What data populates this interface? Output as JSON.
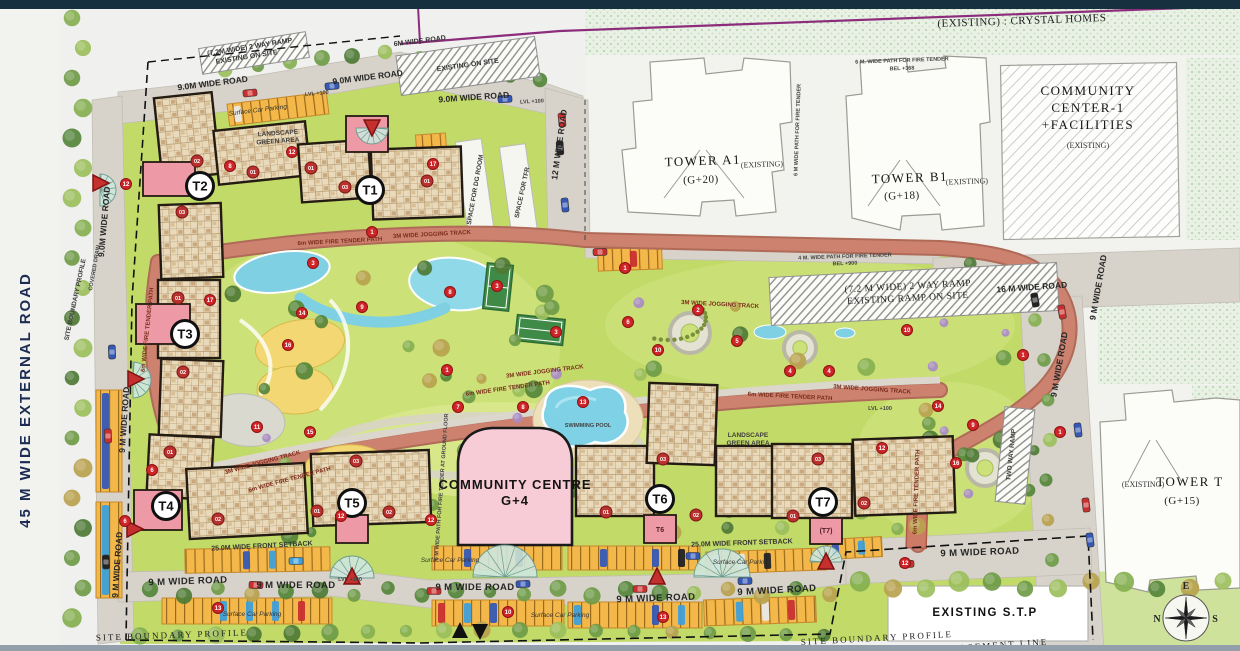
{
  "plan": {
    "title": "Residential Site Master Plan",
    "compass": {
      "n": "N",
      "e": "E",
      "s": "S",
      "w": "W"
    },
    "towers": [
      {
        "id": "T1",
        "x": 370,
        "y": 190
      },
      {
        "id": "T2",
        "x": 200,
        "y": 186
      },
      {
        "id": "T3",
        "x": 185,
        "y": 334
      },
      {
        "id": "T4",
        "x": 166,
        "y": 506
      },
      {
        "id": "T5",
        "x": 352,
        "y": 503
      },
      {
        "id": "T6",
        "x": 660,
        "y": 499
      },
      {
        "id": "T7",
        "x": 823,
        "y": 502
      }
    ],
    "lobby_labels": [
      {
        "t": "T6",
        "x": 660,
        "y": 532
      },
      {
        "t": "(T7)",
        "x": 826,
        "y": 533
      }
    ],
    "unit_badges": [
      {
        "t": "02",
        "x": 197,
        "y": 161
      },
      {
        "t": "01",
        "x": 253,
        "y": 172
      },
      {
        "t": "03",
        "x": 182,
        "y": 212
      },
      {
        "t": "01",
        "x": 311,
        "y": 168
      },
      {
        "t": "03",
        "x": 345,
        "y": 187
      },
      {
        "t": "01",
        "x": 427,
        "y": 181
      },
      {
        "t": "01",
        "x": 178,
        "y": 298
      },
      {
        "t": "02",
        "x": 183,
        "y": 372
      },
      {
        "t": "01",
        "x": 170,
        "y": 452
      },
      {
        "t": "02",
        "x": 218,
        "y": 519
      },
      {
        "t": "01",
        "x": 317,
        "y": 511
      },
      {
        "t": "03",
        "x": 356,
        "y": 461
      },
      {
        "t": "02",
        "x": 389,
        "y": 512
      },
      {
        "t": "01",
        "x": 606,
        "y": 512
      },
      {
        "t": "03",
        "x": 663,
        "y": 459
      },
      {
        "t": "02",
        "x": 696,
        "y": 515
      },
      {
        "t": "01",
        "x": 793,
        "y": 516
      },
      {
        "t": "03",
        "x": 818,
        "y": 459
      },
      {
        "t": "02",
        "x": 864,
        "y": 503
      }
    ],
    "markers": [
      {
        "n": "12",
        "x": 126,
        "y": 184
      },
      {
        "n": "8",
        "x": 230,
        "y": 166
      },
      {
        "n": "12",
        "x": 292,
        "y": 152
      },
      {
        "n": "17",
        "x": 433,
        "y": 164
      },
      {
        "n": "1",
        "x": 372,
        "y": 232
      },
      {
        "n": "3",
        "x": 313,
        "y": 263
      },
      {
        "n": "8",
        "x": 450,
        "y": 292
      },
      {
        "n": "9",
        "x": 362,
        "y": 307
      },
      {
        "n": "14",
        "x": 302,
        "y": 313
      },
      {
        "n": "16",
        "x": 288,
        "y": 345
      },
      {
        "n": "17",
        "x": 210,
        "y": 300
      },
      {
        "n": "11",
        "x": 257,
        "y": 427
      },
      {
        "n": "15",
        "x": 310,
        "y": 432
      },
      {
        "n": "1",
        "x": 447,
        "y": 370
      },
      {
        "n": "7",
        "x": 458,
        "y": 407
      },
      {
        "n": "8",
        "x": 523,
        "y": 407
      },
      {
        "n": "13",
        "x": 583,
        "y": 402
      },
      {
        "n": "3",
        "x": 497,
        "y": 286
      },
      {
        "n": "3",
        "x": 556,
        "y": 332
      },
      {
        "n": "6",
        "x": 628,
        "y": 322
      },
      {
        "n": "10",
        "x": 658,
        "y": 350
      },
      {
        "n": "2",
        "x": 698,
        "y": 310
      },
      {
        "n": "5",
        "x": 737,
        "y": 341
      },
      {
        "n": "4",
        "x": 790,
        "y": 371
      },
      {
        "n": "4",
        "x": 829,
        "y": 371
      },
      {
        "n": "12",
        "x": 882,
        "y": 448
      },
      {
        "n": "14",
        "x": 938,
        "y": 406
      },
      {
        "n": "9",
        "x": 973,
        "y": 425
      },
      {
        "n": "16",
        "x": 956,
        "y": 463
      },
      {
        "n": "1",
        "x": 1023,
        "y": 355
      },
      {
        "n": "1",
        "x": 1060,
        "y": 432
      },
      {
        "n": "10",
        "x": 907,
        "y": 330
      },
      {
        "n": "6",
        "x": 152,
        "y": 470
      },
      {
        "n": "6",
        "x": 125,
        "y": 521
      },
      {
        "n": "12",
        "x": 341,
        "y": 516
      },
      {
        "n": "12",
        "x": 431,
        "y": 520
      },
      {
        "n": "1",
        "x": 625,
        "y": 268
      },
      {
        "n": "13",
        "x": 218,
        "y": 608
      },
      {
        "n": "10",
        "x": 508,
        "y": 612
      },
      {
        "n": "13",
        "x": 663,
        "y": 617
      },
      {
        "n": "12",
        "x": 905,
        "y": 563
      }
    ],
    "labels": [
      {
        "t": "45 M WIDE EXTERNAL ROAD",
        "x": 30,
        "y": 400,
        "r": -90,
        "c": "nav"
      },
      {
        "t": "(EXISTING) : CRYSTAL HOMES",
        "x": 1022,
        "y": 24,
        "r": -2,
        "c": "ser"
      },
      {
        "t": "6M WIDE ROAD",
        "x": 420,
        "y": 43,
        "r": -7,
        "c": "tiny"
      },
      {
        "t": "9.0M WIDE ROAD",
        "x": 213,
        "y": 86,
        "r": -7,
        "c": "rd2"
      },
      {
        "t": "9.0M WIDE ROAD",
        "x": 368,
        "y": 80,
        "r": -7,
        "c": "rd2"
      },
      {
        "t": "9.0M WIDE ROAD",
        "x": 474,
        "y": 100,
        "r": -4,
        "c": "rd2"
      },
      {
        "t": "LVL +100",
        "x": 317,
        "y": 95,
        "r": -6,
        "c": "t5"
      },
      {
        "t": "LVL +100",
        "x": 532,
        "y": 103,
        "r": -3,
        "c": "t5"
      },
      {
        "t": "(7.2M WIDE) 2 WAY RAMP",
        "x": 250,
        "y": 49,
        "r": -9,
        "c": "tiny"
      },
      {
        "t": "EXISTING ON SITE",
        "x": 247,
        "y": 59,
        "r": -9,
        "c": "tiny"
      },
      {
        "t": "EXISTING ON SITE",
        "x": 468,
        "y": 67,
        "r": -8,
        "c": "tiny"
      },
      {
        "t": "12 M WIDE ROAD",
        "x": 562,
        "y": 145,
        "r": -82,
        "c": "rd2"
      },
      {
        "t": "SPACE FOR DG ROOM",
        "x": 477,
        "y": 190,
        "r": -80,
        "c": "t6"
      },
      {
        "t": "SPACE FOR TFR",
        "x": 524,
        "y": 193,
        "r": -78,
        "c": "t6"
      },
      {
        "t": "TOWER A1",
        "x": 703,
        "y": 165,
        "r": -2,
        "c": "ser2"
      },
      {
        "t": "(EXISTING)",
        "x": 762,
        "y": 167,
        "r": -2,
        "c": "serS"
      },
      {
        "t": "(G+20)",
        "x": 701,
        "y": 183,
        "r": -2,
        "c": "ser"
      },
      {
        "t": "6 M. WIDE PATH FOR FIRE TENDER",
        "x": 902,
        "y": 62,
        "r": -2,
        "c": "t5"
      },
      {
        "t": "BEL +368",
        "x": 902,
        "y": 70,
        "r": -2,
        "c": "t5"
      },
      {
        "t": "6 M WIDE PATH FOR FIRE TENDER",
        "x": 799,
        "y": 130,
        "r": -88,
        "c": "t5"
      },
      {
        "t": "TOWER B1",
        "x": 910,
        "y": 182,
        "r": -2,
        "c": "ser2"
      },
      {
        "t": "(EXISTING)",
        "x": 967,
        "y": 184,
        "r": -2,
        "c": "serS"
      },
      {
        "t": "(G+18)",
        "x": 902,
        "y": 199,
        "r": -2,
        "c": "ser"
      },
      {
        "t": "COMMUNITY",
        "x": 1088,
        "y": 95,
        "r": 0,
        "c": "ser2"
      },
      {
        "t": "CENTER-1",
        "x": 1088,
        "y": 112,
        "r": 0,
        "c": "ser2"
      },
      {
        "t": "+FACILITIES",
        "x": 1088,
        "y": 129,
        "r": 0,
        "c": "ser2"
      },
      {
        "t": "(EXISTING)",
        "x": 1088,
        "y": 148,
        "r": 0,
        "c": "serS"
      },
      {
        "t": "4 M. WIDE PATH FOR FIRE TENDER",
        "x": 845,
        "y": 258,
        "r": -2,
        "c": "t5"
      },
      {
        "t": "BEL +900",
        "x": 845,
        "y": 265,
        "r": -2,
        "c": "t5"
      },
      {
        "t": "(7.2 M WIDE) 2 WAY RAMP",
        "x": 908,
        "y": 289,
        "r": -3,
        "c": "ser3"
      },
      {
        "t": "EXISTING RAMP ON SITE",
        "x": 908,
        "y": 301,
        "r": -3,
        "c": "ser3"
      },
      {
        "t": "16 M WIDE ROAD",
        "x": 1032,
        "y": 290,
        "r": -4,
        "c": "rd2"
      },
      {
        "t": "9 M WIDE ROAD",
        "x": 1101,
        "y": 288,
        "r": -80,
        "c": "rd2"
      },
      {
        "t": "9 M WIDE ROAD",
        "x": 1062,
        "y": 365,
        "r": -80,
        "c": "rd2"
      },
      {
        "t": "(EXISTING)",
        "x": 1143,
        "y": 487,
        "r": 0,
        "c": "serS"
      },
      {
        "t": "TOWER T",
        "x": 1190,
        "y": 486,
        "r": 0,
        "c": "ser2"
      },
      {
        "t": "(G+15)",
        "x": 1182,
        "y": 504,
        "r": 0,
        "c": "ser"
      },
      {
        "t": "3M WIDE JOGGING TRACK",
        "x": 432,
        "y": 236,
        "r": -3,
        "c": "trk"
      },
      {
        "t": "6m WIDE FIRE TENDER PATH",
        "x": 340,
        "y": 243,
        "r": -3,
        "c": "trk"
      },
      {
        "t": "3M WIDE JOGGING TRACK",
        "x": 720,
        "y": 306,
        "r": 3,
        "c": "trk"
      },
      {
        "t": "3M WIDE JOGGING TRACK",
        "x": 545,
        "y": 373,
        "r": -7,
        "c": "trk"
      },
      {
        "t": "6m WIDE FIRE TENDER PATH",
        "x": 508,
        "y": 390,
        "r": -8,
        "c": "trk"
      },
      {
        "t": "6m WIDE FIRE TENDER PATH",
        "x": 149,
        "y": 330,
        "r": -84,
        "c": "trk"
      },
      {
        "t": "3M WIDE JOGGING TRACK",
        "x": 263,
        "y": 464,
        "r": -15,
        "c": "trk"
      },
      {
        "t": "6m WIDE FIRE TENDER PATH",
        "x": 290,
        "y": 481,
        "r": -15,
        "c": "trk"
      },
      {
        "t": "3M WIDE JOGGING TRACK",
        "x": 872,
        "y": 391,
        "r": 4,
        "c": "trk"
      },
      {
        "t": "6m WIDE FIRE TENDER PATH",
        "x": 790,
        "y": 398,
        "r": 3,
        "c": "trk"
      },
      {
        "t": "6m WIDE FIRE TENDER PATH",
        "x": 918,
        "y": 492,
        "r": -88,
        "c": "trk"
      },
      {
        "t": "6 M WIDE PATH FOR FIRE TENDER AT GROUND FLOOR",
        "x": 443,
        "y": 487,
        "r": -86,
        "c": "t5"
      },
      {
        "t": "TWO WAY RAMP",
        "x": 1013,
        "y": 455,
        "r": -84,
        "c": "t6"
      },
      {
        "t": "LANDSCAPE",
        "x": 278,
        "y": 135,
        "r": -4,
        "c": "t6"
      },
      {
        "t": "GREEN AREA",
        "x": 278,
        "y": 143,
        "r": -4,
        "c": "t6"
      },
      {
        "t": "LANDSCAPE",
        "x": 748,
        "y": 437,
        "r": 0,
        "c": "t6"
      },
      {
        "t": "GREEN AREA",
        "x": 748,
        "y": 445,
        "r": 0,
        "c": "t6"
      },
      {
        "t": "LVL +100",
        "x": 880,
        "y": 410,
        "r": 0,
        "c": "t5"
      },
      {
        "t": "SWIMMING POOL",
        "x": 588,
        "y": 427,
        "r": 0,
        "c": "t5"
      },
      {
        "t": "COMMUNITY CENTRE",
        "x": 515,
        "y": 489,
        "r": 0,
        "c": "cc"
      },
      {
        "t": "G+4",
        "x": 515,
        "y": 505,
        "r": 0,
        "c": "cc"
      },
      {
        "t": "EXISTING  S.T.P",
        "x": 985,
        "y": 616,
        "r": 0,
        "c": "stp"
      },
      {
        "t": "25.0M WIDE FRONT SETBACK",
        "x": 262,
        "y": 548,
        "r": -3,
        "c": "tiny"
      },
      {
        "t": "25.0M WIDE FRONT SETBACK",
        "x": 742,
        "y": 545,
        "r": -2,
        "c": "tiny"
      },
      {
        "t": "9 M WIDE ROAD",
        "x": 188,
        "y": 584,
        "r": -2,
        "c": "rd"
      },
      {
        "t": "9 M WIDE ROAD",
        "x": 296,
        "y": 588,
        "r": 0,
        "c": "rd"
      },
      {
        "t": "9 M WIDE ROAD",
        "x": 475,
        "y": 590,
        "r": 0,
        "c": "rd"
      },
      {
        "t": "9 M WIDE ROAD",
        "x": 656,
        "y": 601,
        "r": -2,
        "c": "rd"
      },
      {
        "t": "9 M WIDE ROAD",
        "x": 777,
        "y": 593,
        "r": -3,
        "c": "rd"
      },
      {
        "t": "9 M WIDE ROAD",
        "x": 980,
        "y": 555,
        "r": -2,
        "c": "rd"
      },
      {
        "t": "LVL +100",
        "x": 350,
        "y": 581,
        "r": 0,
        "c": "t5"
      },
      {
        "t": "Surface Car Parking",
        "x": 258,
        "y": 112,
        "r": -7,
        "c": "tinyi"
      },
      {
        "t": "Surface Car Parking",
        "x": 450,
        "y": 562,
        "r": 0,
        "c": "tinyi"
      },
      {
        "t": "Surface Car Parking",
        "x": 560,
        "y": 617,
        "r": 0,
        "c": "tinyi"
      },
      {
        "t": "Surface Car Parking",
        "x": 252,
        "y": 616,
        "r": 0,
        "c": "tinyi"
      },
      {
        "t": "Surface Car Parking",
        "x": 742,
        "y": 564,
        "r": 0,
        "c": "tinyi"
      },
      {
        "t": "SITE BOUNDARY PROFILE",
        "x": 77,
        "y": 300,
        "r": -78,
        "c": "t6"
      },
      {
        "t": "SITE BOUNDARY PROFILE",
        "x": 172,
        "y": 638,
        "r": -2,
        "c": "bnd"
      },
      {
        "t": "SITE BOUNDARY PROFILE",
        "x": 877,
        "y": 641,
        "r": -3,
        "c": "bnd"
      },
      {
        "t": "BASEMENT LINE",
        "x": 1000,
        "y": 648,
        "r": -4,
        "c": "bnd"
      },
      {
        "t": "9 M WIDE ROAD",
        "x": 127,
        "y": 420,
        "r": -86,
        "c": "rd2"
      },
      {
        "t": "9 M WIDE ROAD",
        "x": 120,
        "y": 565,
        "r": -86,
        "c": "rd2"
      },
      {
        "t": "9.0M WIDE ROAD",
        "x": 107,
        "y": 222,
        "r": -85,
        "c": "rd2"
      },
      {
        "t": "COVERED DRAIN",
        "x": 96,
        "y": 268,
        "r": -80,
        "c": "t5"
      }
    ]
  }
}
